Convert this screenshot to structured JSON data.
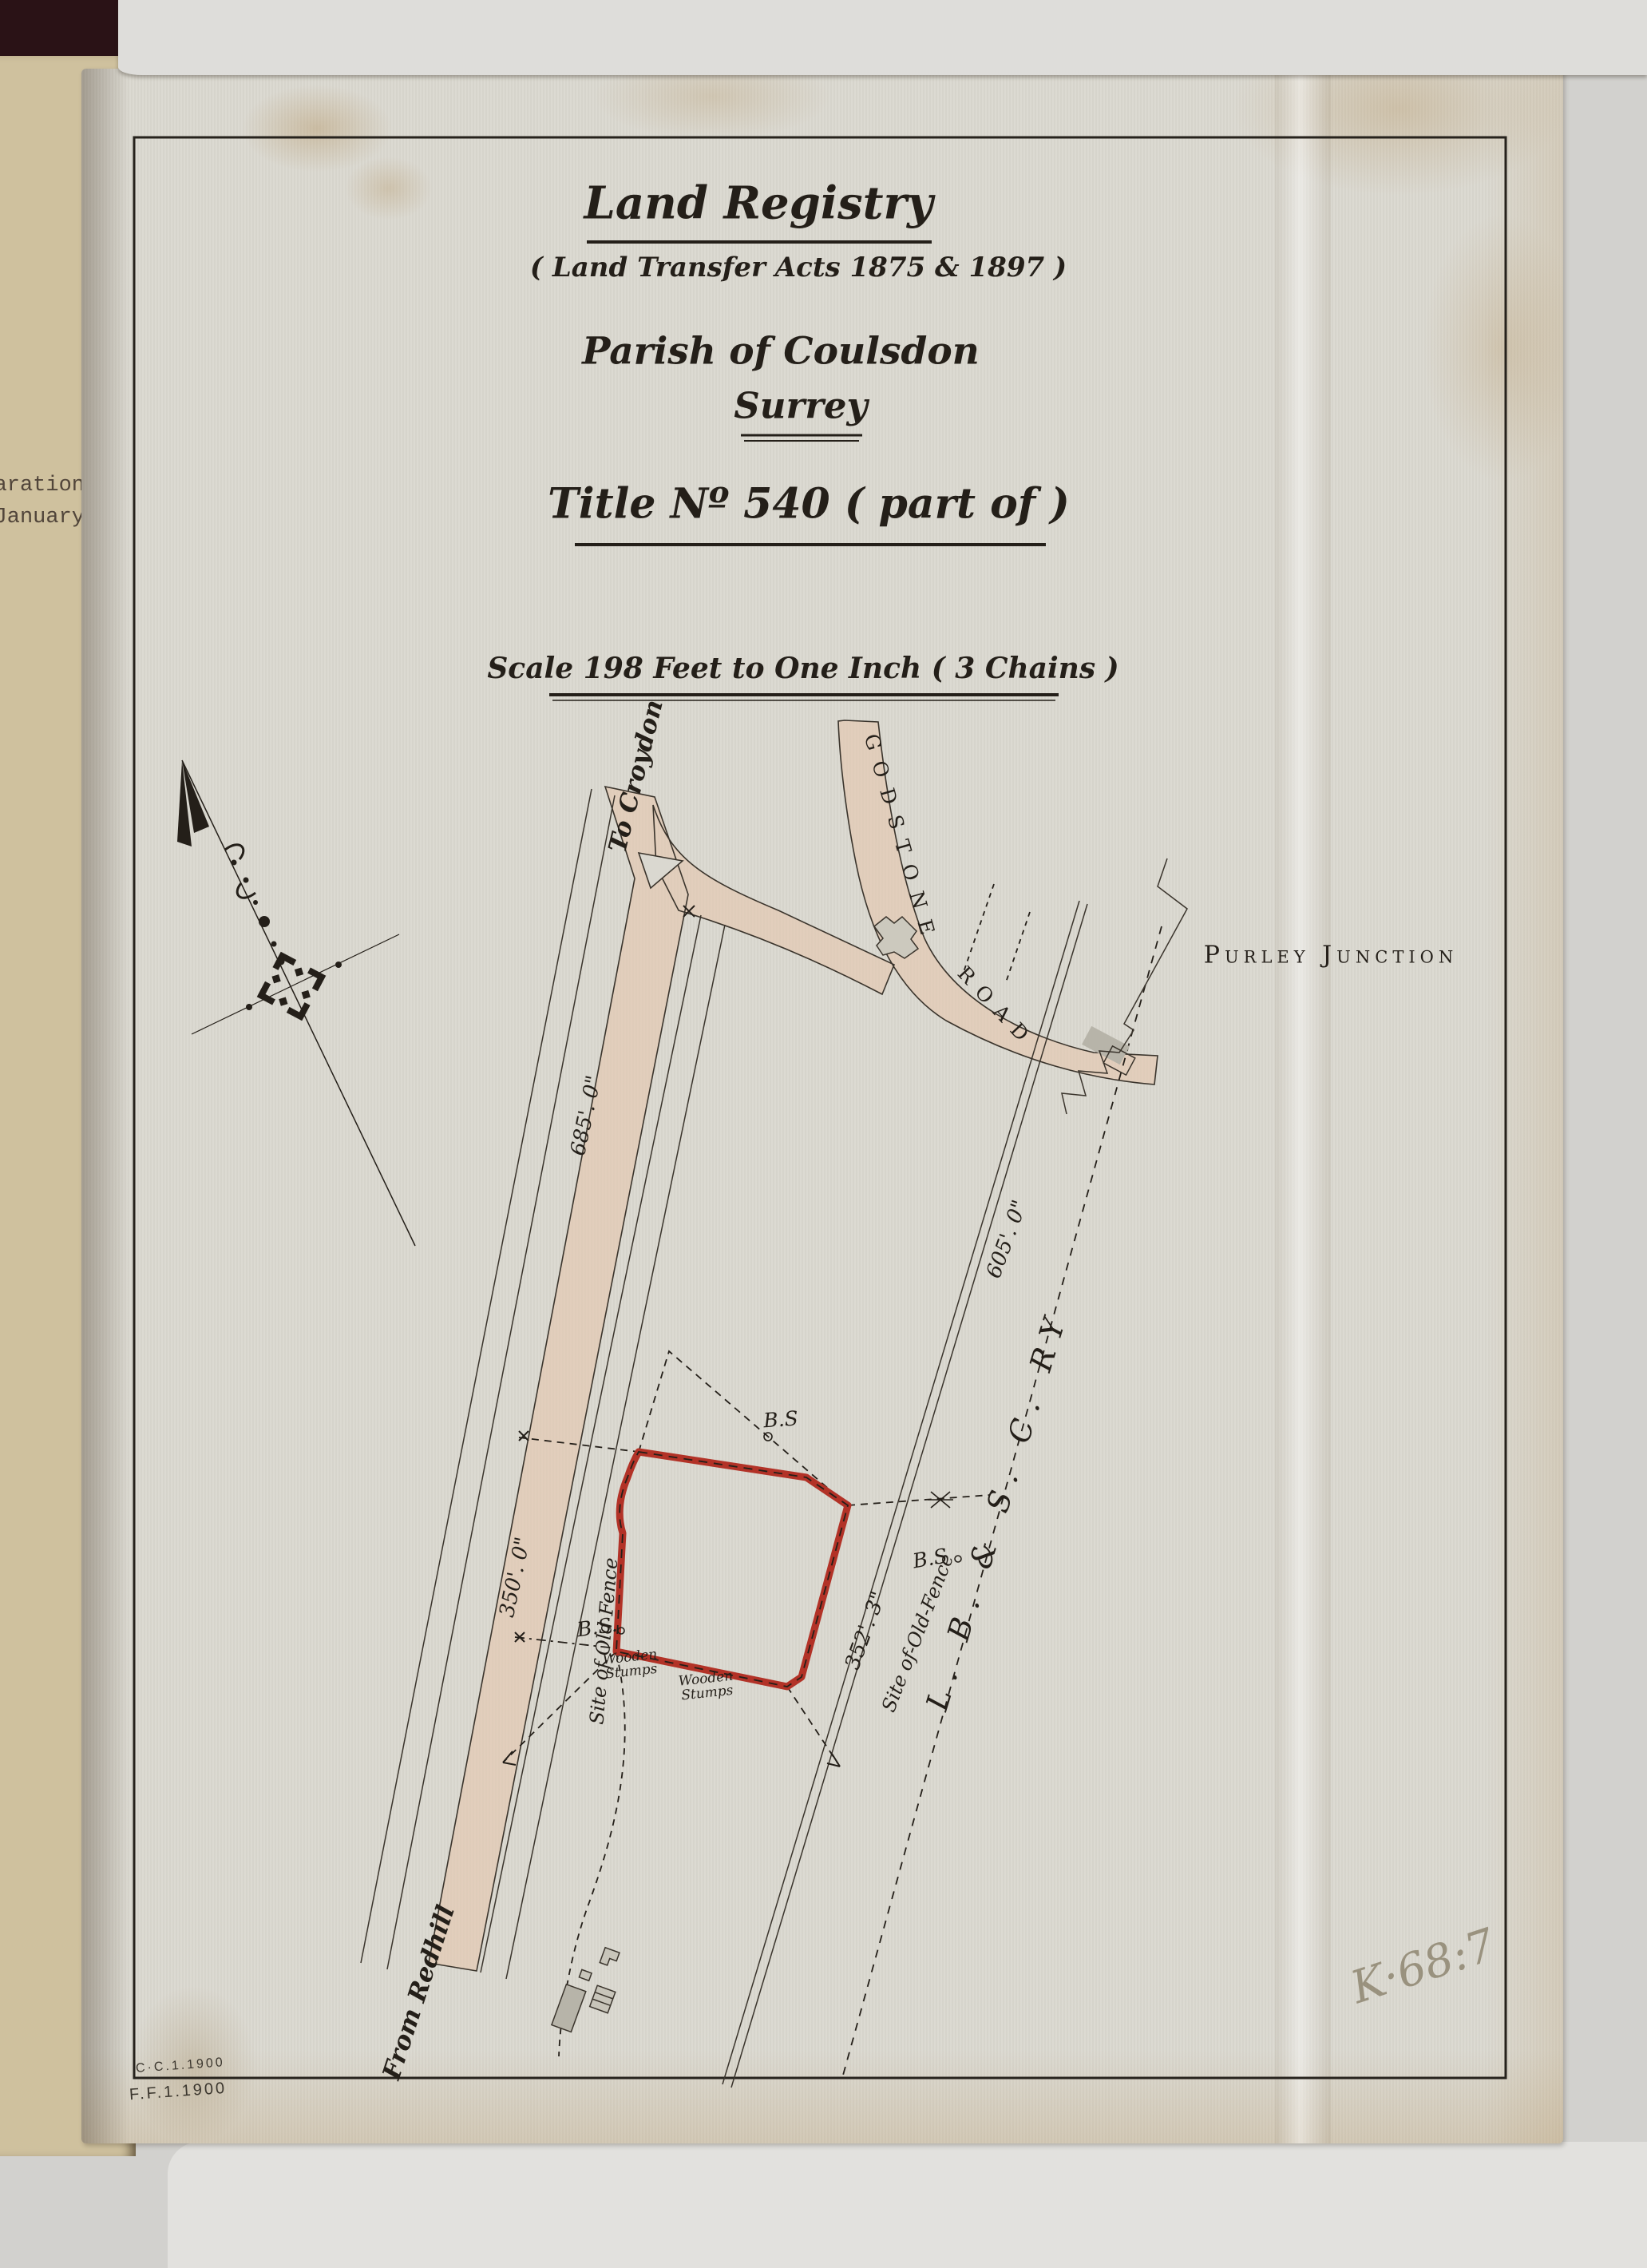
{
  "title_block": {
    "heading": "Land Registry",
    "subheading": "( Land Transfer Acts 1875 & 1897 )",
    "parish_line": "Parish of Coulsdon",
    "county_line": "Surrey",
    "title_line": "Title Nº 540 ( part of )",
    "scale_line": "Scale 198 Feet to One Inch ( 3 Chains )"
  },
  "map": {
    "road_labels": {
      "to_croydon": "To Croydon",
      "from_redhill": "From Redhill",
      "godstone": "GODSTONE",
      "road": "ROAD"
    },
    "place_labels": {
      "purley_junction": "Purley Junction",
      "railway": "L. B. & S. C. RY"
    },
    "dimensions": {
      "d685": "685'. 0\"",
      "d350": "350'. 0\"",
      "d605": "605'. 0\"",
      "d352": "352'. 3\""
    },
    "bench_marks": {
      "top": "B.S",
      "right": "B.S",
      "left": "B.S."
    },
    "fence_labels": {
      "left": "Site of Old Fence",
      "right": "Site of-Old-Fence"
    },
    "stump_labels": {
      "first_line1": "Wooden",
      "first_line2": "Stumps",
      "second_line1": "Wooden",
      "second_line2": "Stumps"
    }
  },
  "adjacent_page": {
    "line1": "aration",
    "line2": "January"
  },
  "stamps": {
    "line1": "C·C.1.1900",
    "line2": "F.F.1.1900"
  },
  "handwritten": {
    "mark": "K·68:7"
  },
  "colors": {
    "parcel-red": "#b23227",
    "road-tint": "#e5c7ae",
    "ink": "#2b2620",
    "sheet": "#dad8d0"
  }
}
